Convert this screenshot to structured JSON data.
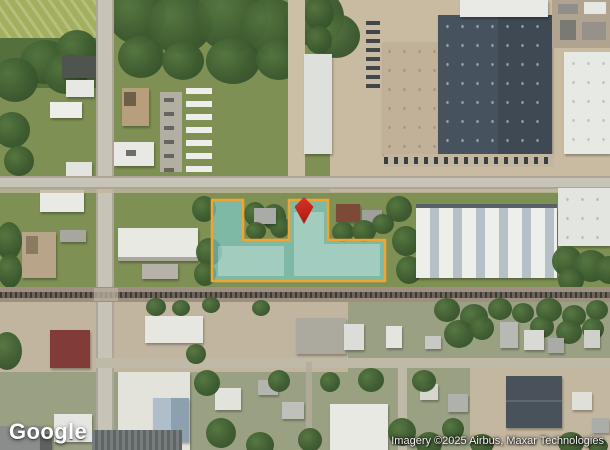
{
  "branding": {
    "logo_text": "Google"
  },
  "attribution": {
    "text": "Imagery ©2025 Airbus, Maxar Technologies"
  },
  "colors": {
    "parcel_fill": "#7ED8E2",
    "parcel_stroke": "#F0A432",
    "pin_red": "#C42318"
  },
  "map": {
    "view_type": "satellite",
    "parcel": {
      "points": [
        [
          212,
          200
        ],
        [
          243,
          200
        ],
        [
          243,
          240
        ],
        [
          289,
          240
        ],
        [
          289,
          200
        ],
        [
          328,
          200
        ],
        [
          328,
          240
        ],
        [
          385,
          240
        ],
        [
          385,
          281
        ],
        [
          212,
          281
        ]
      ]
    },
    "pin": {
      "icon": "location-pin",
      "x": 304,
      "y": 197
    }
  }
}
